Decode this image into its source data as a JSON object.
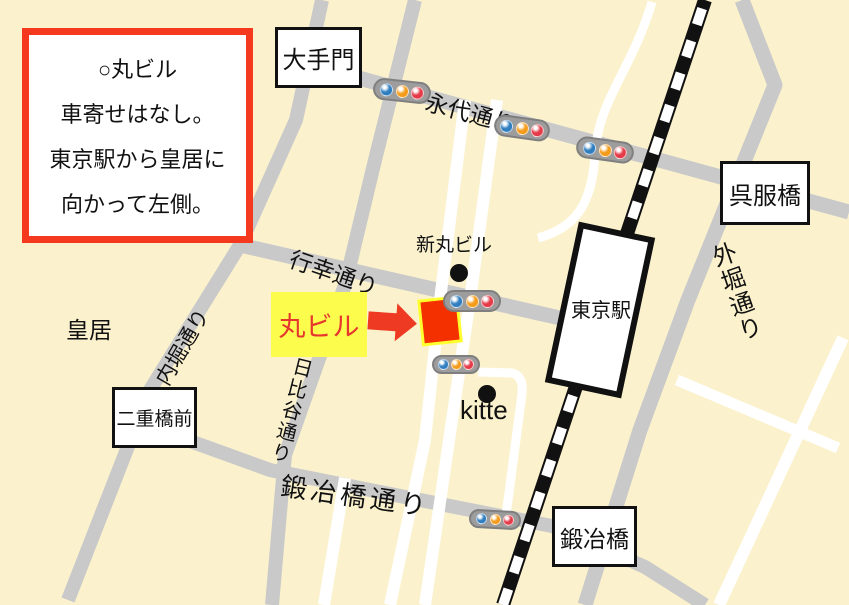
{
  "info_box": {
    "lines": [
      "○丸ビル",
      "車寄せはなし。",
      "東京駅から皇居に",
      "向かって左側。"
    ]
  },
  "place_boxes": {
    "otemon": "大手門",
    "gofukubashi": "呉服橋",
    "nijubashimae": "二重橋前",
    "kajibashi": "鍛冶橋"
  },
  "station": {
    "tokyo": "東京駅"
  },
  "roads": {
    "eitai": "永代通り",
    "gyoko": "行幸通り",
    "uchibori": "内堀通り",
    "hibiya": "日比谷通り",
    "kajibashi_dori": "鍛冶橋通り",
    "sotobori": "外堀通り"
  },
  "landmarks": {
    "kokyo": "皇居",
    "shinmaru": "新丸ビル",
    "kitte": "kitte",
    "marubiru": "丸ビル"
  },
  "colors": {
    "background": "#FBF2CD",
    "road_gray": "#C9C9C9",
    "accent_red": "#F5391F",
    "highlight_yellow": "#FCFC4C",
    "building_red": "#F53000",
    "traffic_light_blue": "#2F7EC0",
    "traffic_light_orange": "#F49C1A",
    "traffic_light_red": "#E53A47"
  },
  "traffic_light_colors": [
    "blue",
    "orange",
    "red"
  ]
}
